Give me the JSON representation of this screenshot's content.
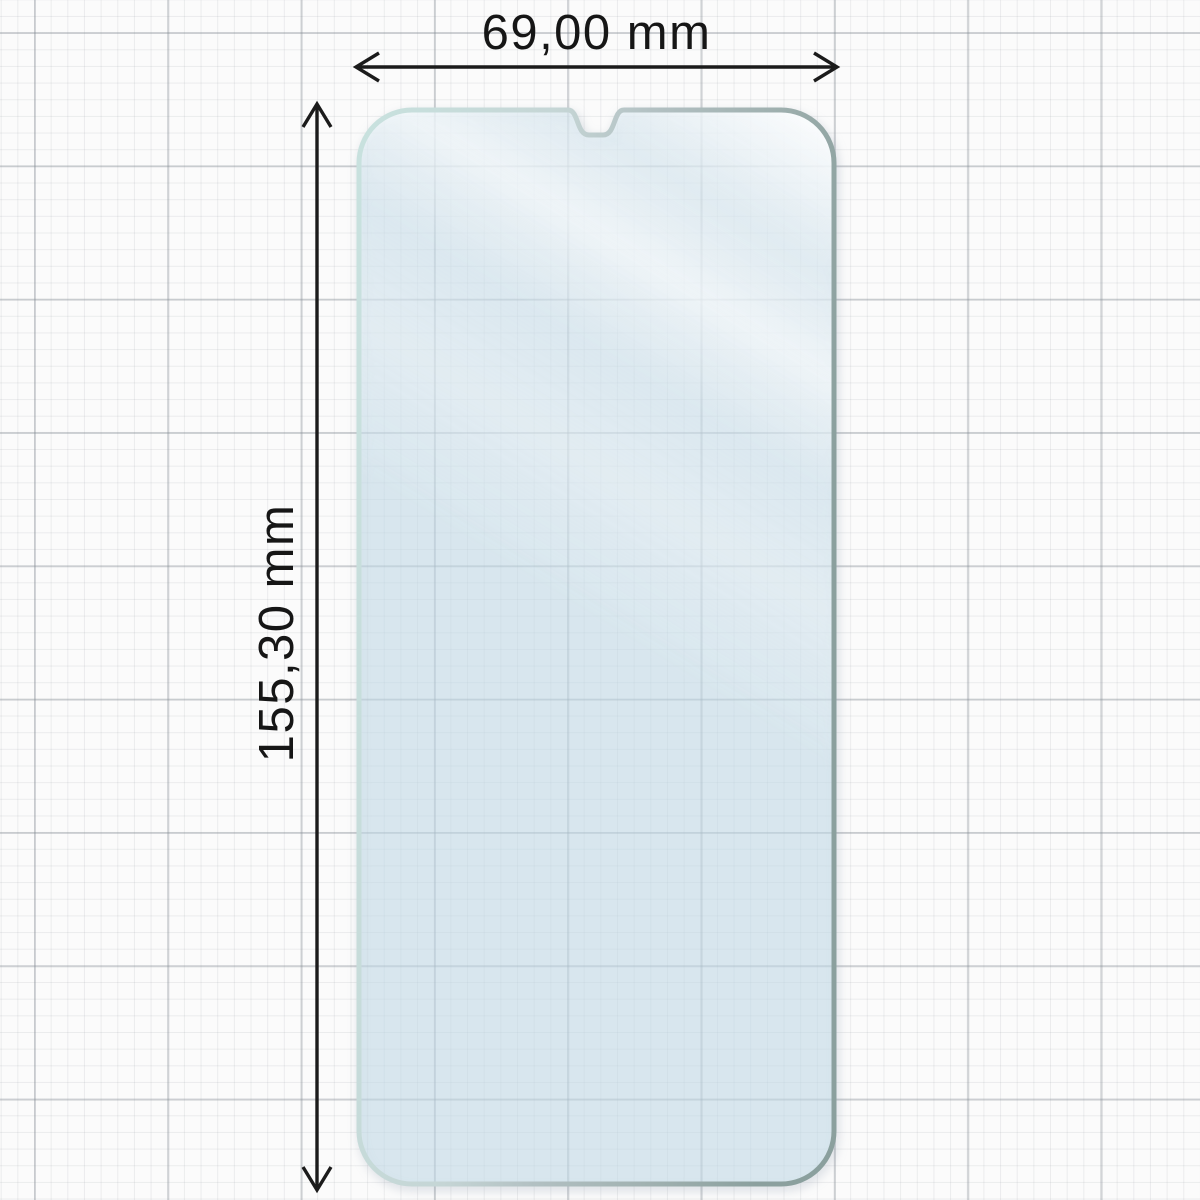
{
  "diagram": {
    "type": "product-dimension-diagram",
    "subject": "smartphone-screen-protector-film",
    "background_style": "graph-paper-grid",
    "dimensions": {
      "width": {
        "label": "69,00 mm",
        "value_mm": 69.0,
        "arrow": "horizontal-double-headed"
      },
      "height": {
        "label": "155,30 mm",
        "value_mm": 155.3,
        "arrow": "vertical-double-headed"
      }
    },
    "film_features": {
      "corners": "rounded",
      "notch": "waterdrop-notch-top-center"
    },
    "colors": {
      "canvas_background": "#fbfbfb",
      "grid_minor": "#e9eaeb",
      "grid_major": "#c6c9cc",
      "dimension_line": "#1b1b1b",
      "label_text": "#161616",
      "film_tint": "#c9e3ef",
      "film_highlight": "#ffffff",
      "film_edge_light": "#c8e1de",
      "film_edge_dark": "#8ba09e",
      "film_edge_metal_band": "#9ca5b4"
    }
  }
}
